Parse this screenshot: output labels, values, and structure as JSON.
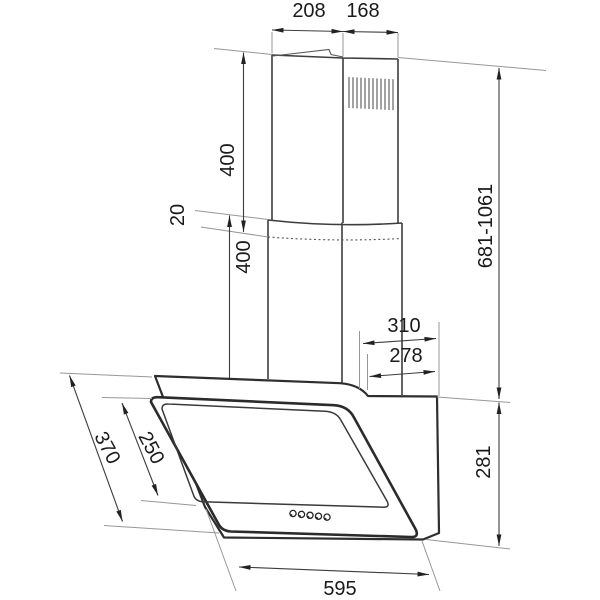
{
  "drawing": {
    "subject": "wall-mounted angled cooker hood with telescopic chimney, dimensioned line drawing",
    "units": "mm",
    "colors": {
      "background": "#ffffff",
      "outline": "#2e2e2e",
      "dimension_line": "#3c3c3c",
      "extension_line": "#979797",
      "text": "#1a1a1a"
    }
  },
  "dims": {
    "chimney_top_width": "208",
    "chimney_top_depth": "168",
    "upper_flue_length": "400",
    "flue_overlap": "20",
    "lower_flue_length": "400",
    "total_height_range": "681-1061",
    "top_depth_outer": "310",
    "top_depth_inner": "278",
    "front_panel_length": "370",
    "glass_inner_length": "250",
    "body_height": "281",
    "hood_width": "595"
  },
  "features": {
    "vent_grille_slots": 12,
    "control_buttons": 5
  }
}
